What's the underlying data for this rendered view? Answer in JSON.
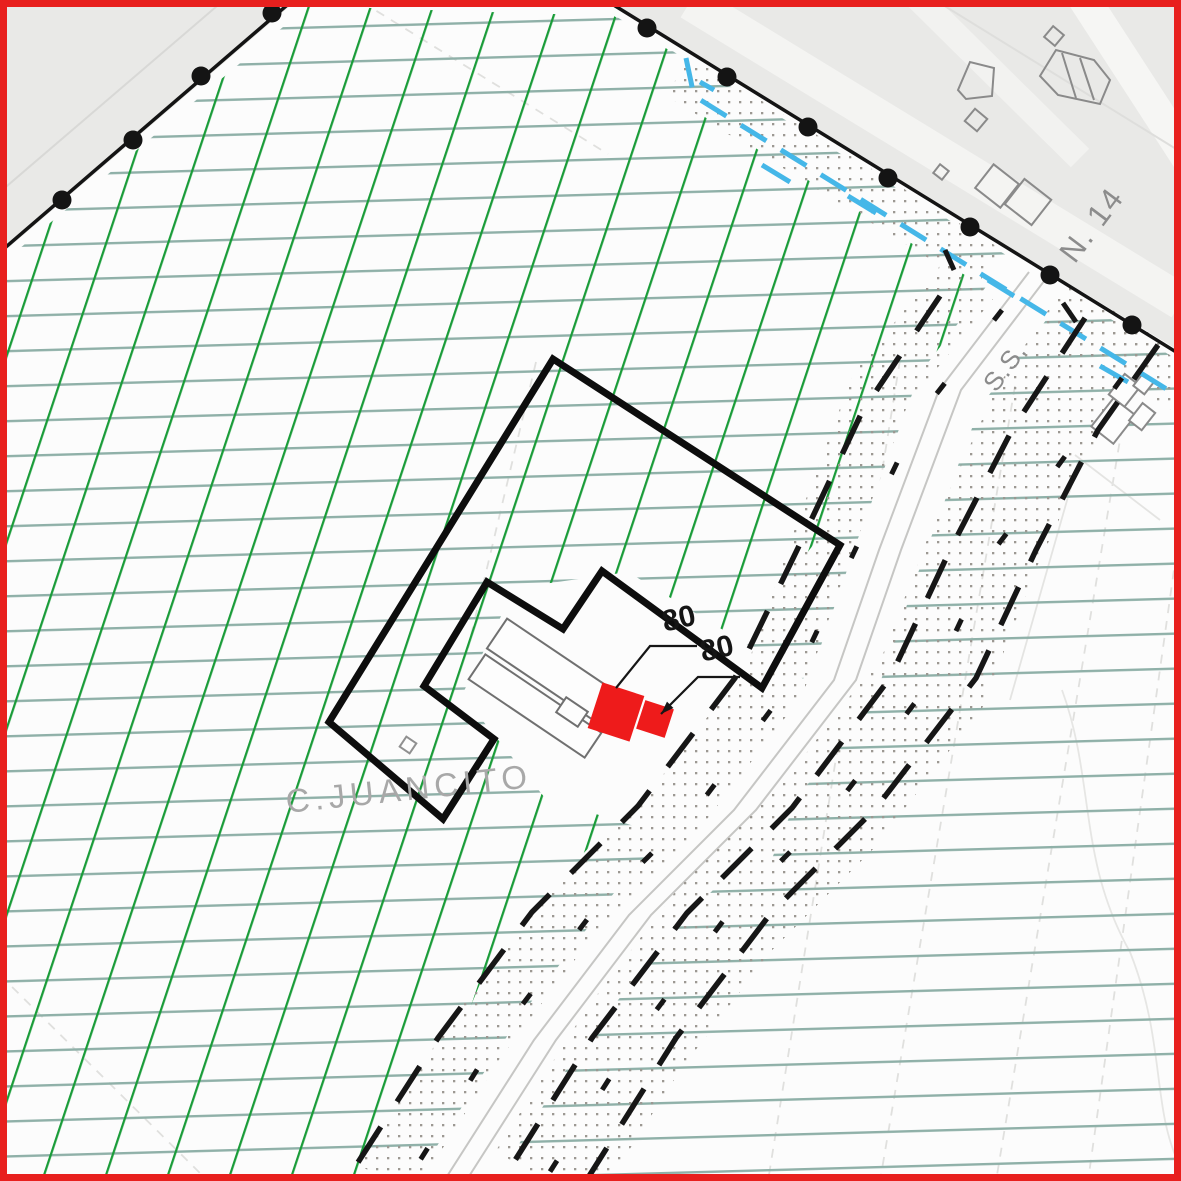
{
  "map": {
    "labels": {
      "street_name": "C.JUANCITO",
      "route_number": "N. 14",
      "road_abbrev": "S.S.",
      "dimension_label_1": "80",
      "dimension_label_2": "80"
    },
    "colors": {
      "frame_red": "#e8201e",
      "zone_hatch_green": "#1a9c39",
      "contour_line_teal": "#8fb0a8",
      "overlay_cyan": "#45b7e8",
      "parcel_boundary_black": "#141414",
      "highlight_building_red": "#ee1b1b",
      "urban_area_gray": "#e9e9e7",
      "dot_texture_gray": "#9c9892",
      "label_gray": "#a8a8a8"
    }
  }
}
